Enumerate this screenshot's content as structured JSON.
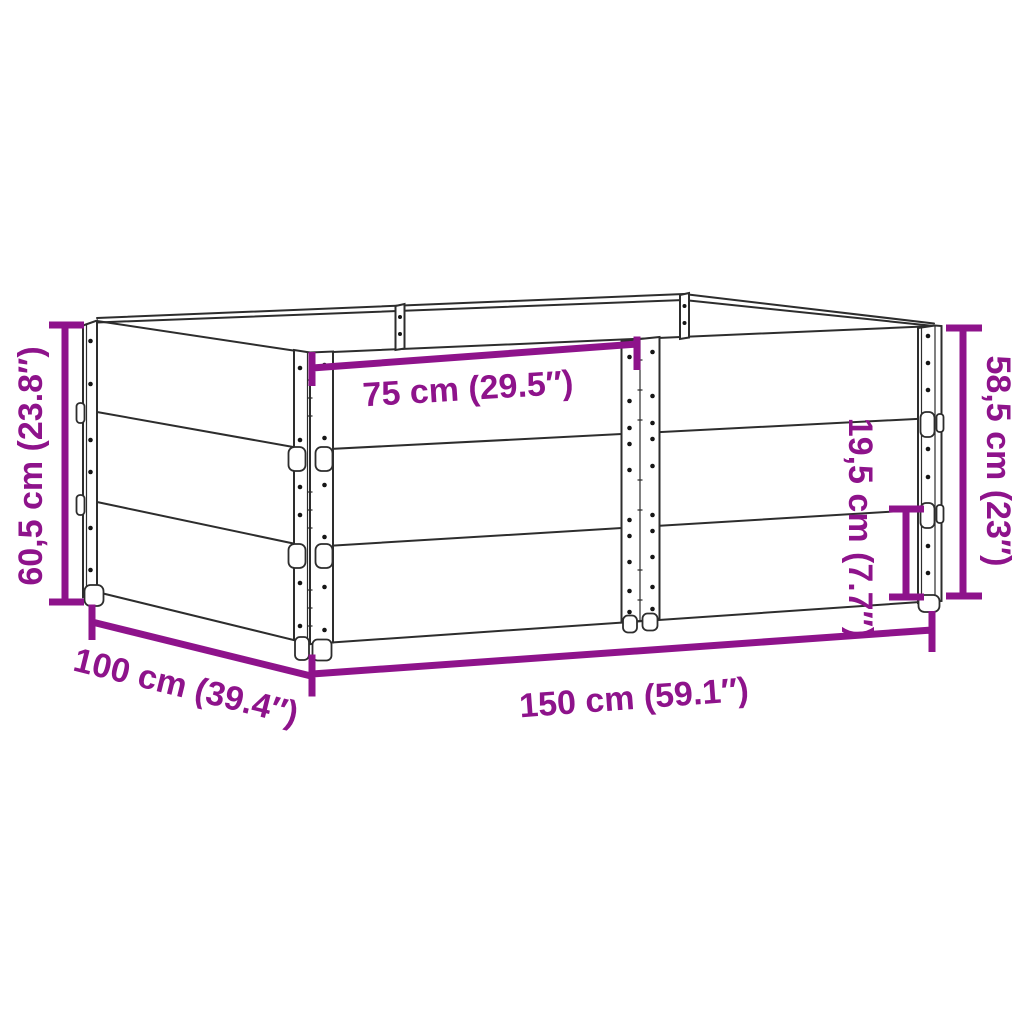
{
  "meta": {
    "title": "Pallet collar / raised bed dimension diagram",
    "tiers_visible": 3
  },
  "colors": {
    "accent": "#8E138B",
    "line": "#2d2d2d",
    "background": "#ffffff"
  },
  "labels": {
    "height_total_left": "60,5 cm (23.8″)",
    "height_right": "58,5 cm (23″)",
    "single_collar_height": "19,5 cm (7.7″)",
    "top_half_width": "75 cm (29.5″)",
    "side_depth": "100 cm (39.4″)",
    "front_length": "150 cm (59.1″)"
  }
}
